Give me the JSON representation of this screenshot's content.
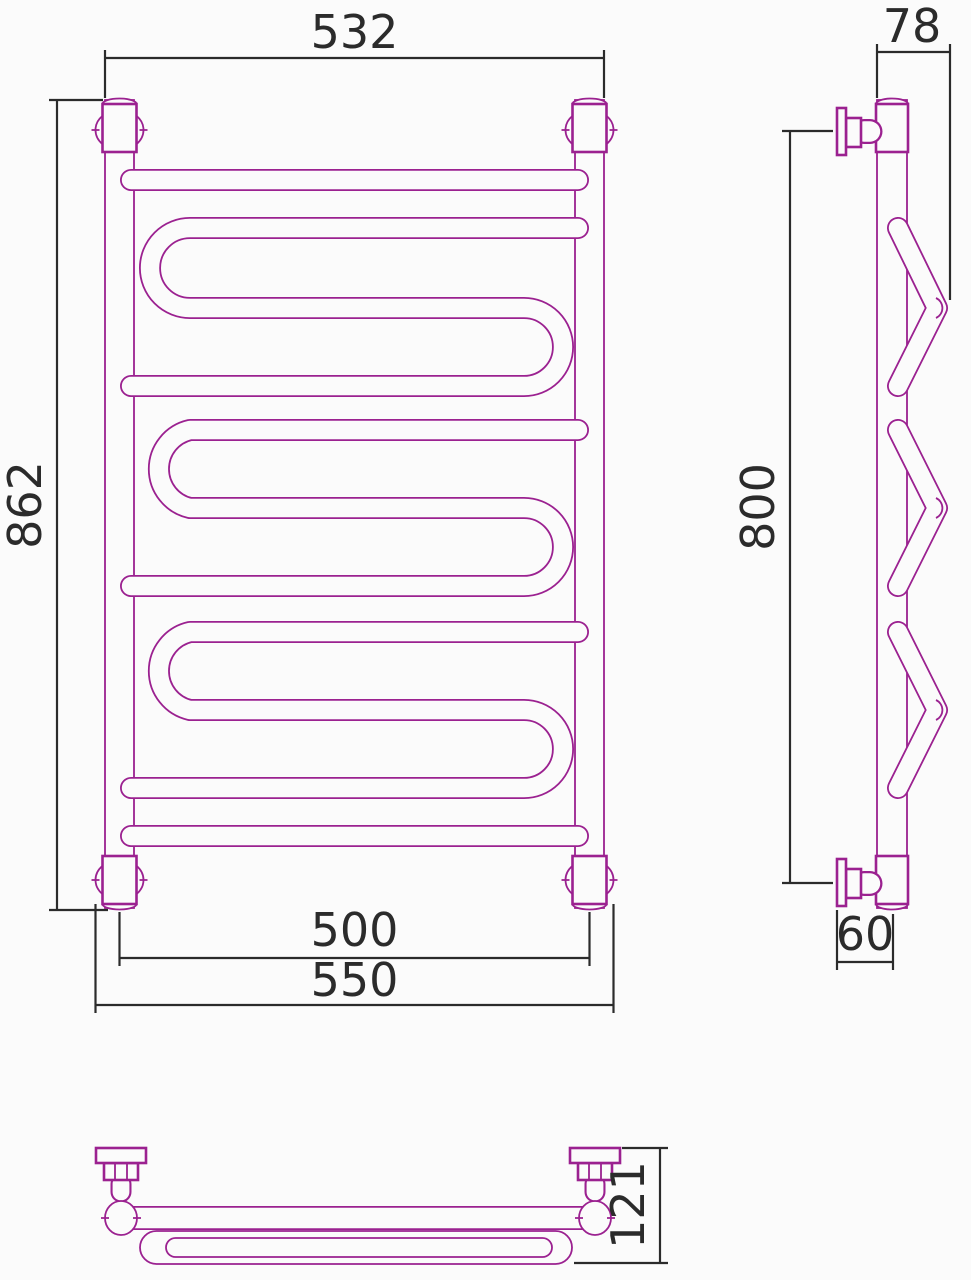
{
  "colors": {
    "outline": "#9b2190",
    "dimension": "#2b2b2b",
    "paper": "#fbfbfb"
  },
  "dimensions": {
    "front": {
      "overall_width": "532",
      "overall_height": "862",
      "pipe_center_width": "500",
      "flange_width": "550"
    },
    "side": {
      "top_depth": "78",
      "mount_height": "800",
      "wall_offset": "60"
    },
    "top": {
      "overall_depth": "121"
    }
  }
}
